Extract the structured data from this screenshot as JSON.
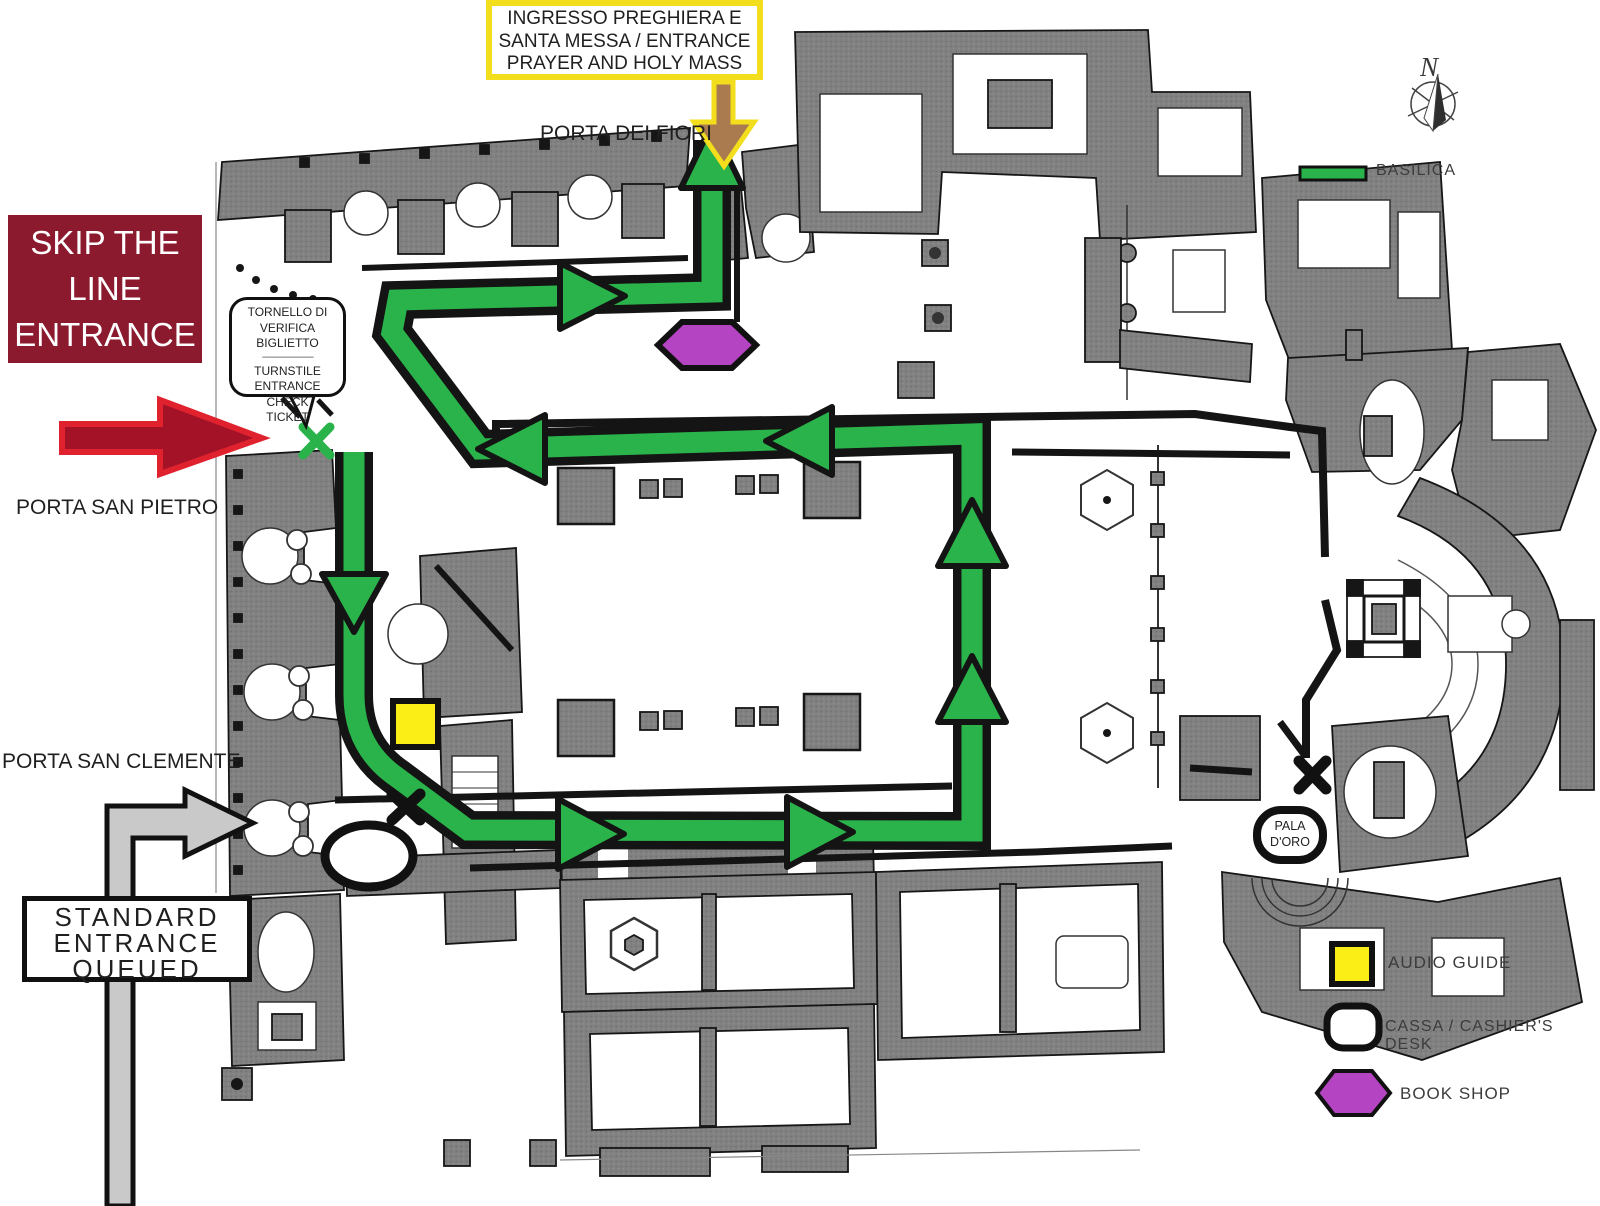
{
  "colors": {
    "route_green": "#2BB34B",
    "audio_yellow": "#FBEE17",
    "shop_purple": "#B444C2",
    "skip_maroon": "#8C1A2E",
    "arrow_red_fill": "#A31226",
    "arrow_red_stroke": "#E0222E",
    "entrance_brown": "#A97B4F",
    "mass_yellow": "#F2DE1C",
    "queue_gray": "#C9C9C9",
    "ink": "#1F1F1F"
  },
  "mass_entrance_box": {
    "line1": "INGRESSO PREGHIERA E",
    "line2": "SANTA MESSA / ENTRANCE",
    "line3": "PRAYER AND HOLY MASS"
  },
  "labels": {
    "porta_dei_fiori": "PORTA DEI FIORI",
    "porta_san_pietro": "PORTA SAN PIETRO",
    "porta_san_clemente": "PORTA SAN CLEMENTE",
    "compass_north": "N"
  },
  "skip_the_line_box": {
    "line1": "SKIP THE",
    "line2": "LINE",
    "line3": "ENTRANCE"
  },
  "turnstile_callout": {
    "line1": "TORNELLO DI",
    "line2": "VERIFICA BIGLIETTO",
    "divider": "----------------------",
    "line3": "TURNSTILE",
    "line4": "ENTRANCE CHECK",
    "line5": "TICKET"
  },
  "standard_entrance_box": {
    "line1": "STANDARD",
    "line2": "ENTRANCE",
    "line3": "QUEUED"
  },
  "map_markers": {
    "pala_line1": "PALA",
    "pala_line2": "D'ORO"
  },
  "legend": {
    "basilica": "BASILICA",
    "audio_guide": "AUDIO GUIDE",
    "cassa": "CASSA / CASHIER'S DESK",
    "book_shop": "BOOK SHOP"
  }
}
